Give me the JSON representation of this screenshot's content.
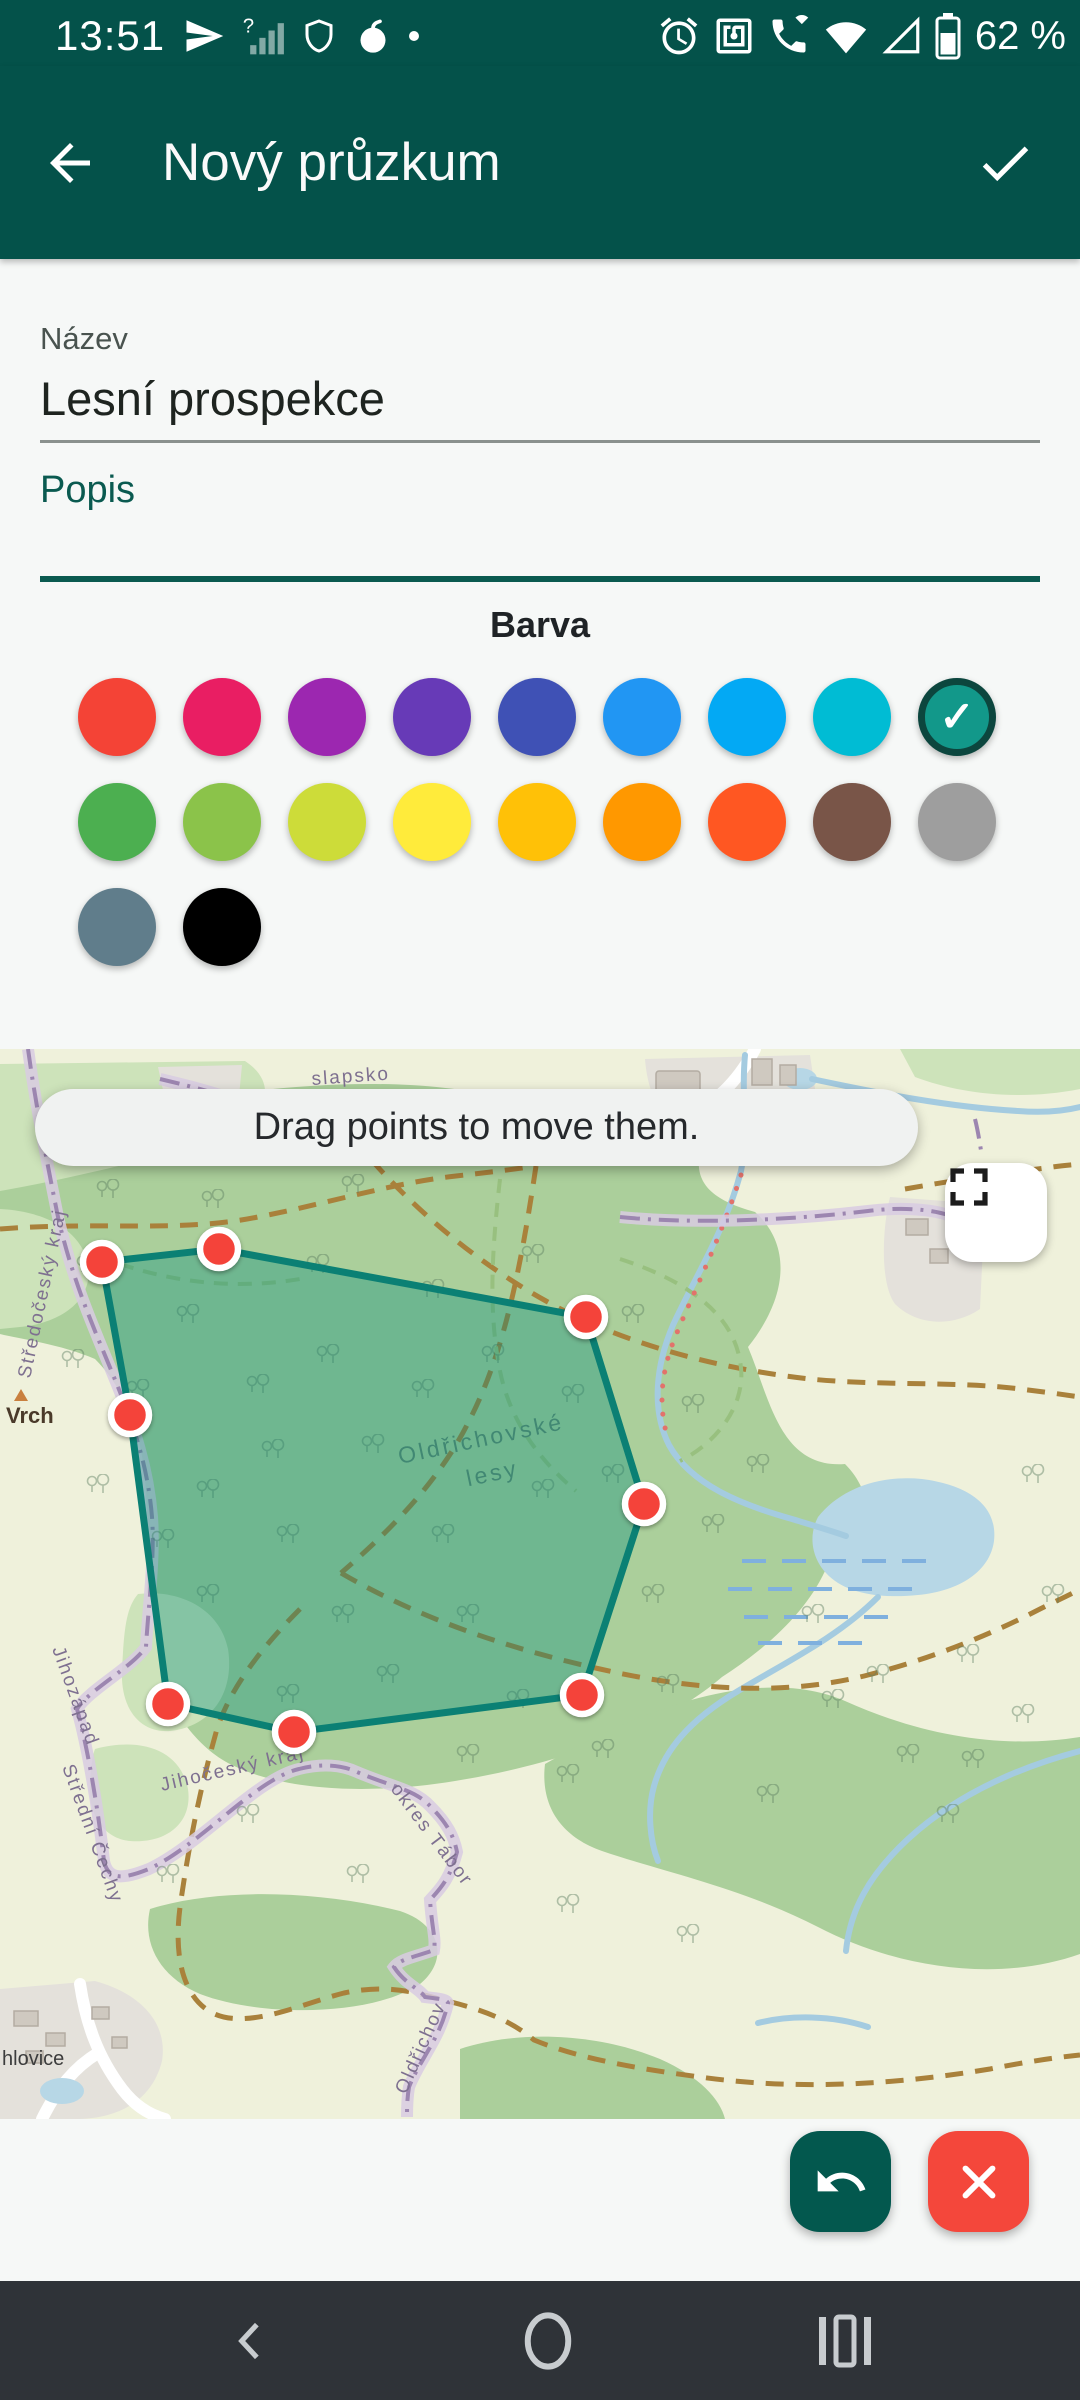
{
  "theme": {
    "appbar": "#04524A",
    "accent-text": "#0A5A50",
    "marker": "#F4433A",
    "undo": "#03584E",
    "close": "#F4473B",
    "map_forest": "#ABCF9B",
    "map_water": "#B7D7E6",
    "map_path": "#A9813B",
    "map_boundary": "#9C86B0"
  },
  "status_bar": {
    "time": "13:51",
    "battery_percent": "62 %"
  },
  "app_bar": {
    "title": "Nový průzkum"
  },
  "form": {
    "name_label": "Název",
    "name_value": "Lesní prospekce",
    "description_label": "Popis",
    "description_value": ""
  },
  "color_picker": {
    "title": "Barva",
    "selected_index": 8,
    "check_glyph": "✓",
    "colors": [
      {
        "name": "red",
        "hex": "#F44336"
      },
      {
        "name": "pink",
        "hex": "#E91E63"
      },
      {
        "name": "purple",
        "hex": "#9C27B0"
      },
      {
        "name": "deep-purple",
        "hex": "#673AB7"
      },
      {
        "name": "indigo",
        "hex": "#3F51B5"
      },
      {
        "name": "blue",
        "hex": "#2196F3"
      },
      {
        "name": "light-blue",
        "hex": "#03A9F4"
      },
      {
        "name": "cyan",
        "hex": "#00BCD4"
      },
      {
        "name": "teal",
        "hex": "#12988A"
      },
      {
        "name": "green",
        "hex": "#4CAF50"
      },
      {
        "name": "light-green",
        "hex": "#8BC34A"
      },
      {
        "name": "lime",
        "hex": "#CDDC39"
      },
      {
        "name": "yellow",
        "hex": "#FFEB3B"
      },
      {
        "name": "amber",
        "hex": "#FFC107"
      },
      {
        "name": "orange",
        "hex": "#FF9800"
      },
      {
        "name": "deep-orange",
        "hex": "#FF5722"
      },
      {
        "name": "brown",
        "hex": "#795548"
      },
      {
        "name": "grey",
        "hex": "#9E9E9E"
      },
      {
        "name": "blue-grey",
        "hex": "#607D8B"
      },
      {
        "name": "black",
        "hex": "#000000"
      }
    ]
  },
  "map": {
    "toast_text": "Drag points to move them.",
    "labels": {
      "hamlet_top": "slapsko",
      "region_left": "Středočeský kraj",
      "peak": "Vrch",
      "forest_name_line1": "Oldřichovské",
      "forest_name_line2": "lesy",
      "region_southwest": "Jihozápad",
      "region_central": "Střední Čechy",
      "region_south": "Jihočeský kraj",
      "district": "okres Tábor",
      "boundary_village": "Oldřichov",
      "town_bottom": "hlovice"
    },
    "polygon": {
      "stroke": "#0B8074",
      "fill": "rgba(0,137,123,0.35)",
      "vertices": [
        [
          102,
          213
        ],
        [
          219,
          200
        ],
        [
          586,
          268
        ],
        [
          644,
          455
        ],
        [
          582,
          646
        ],
        [
          294,
          683
        ],
        [
          168,
          655
        ],
        [
          130,
          366
        ]
      ]
    }
  }
}
